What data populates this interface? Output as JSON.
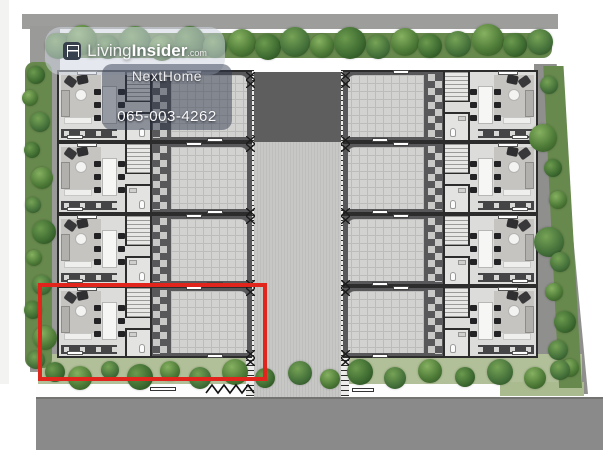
{
  "watermark": {
    "brand_part1": "Living",
    "brand_part2": "Insider",
    "brand_suffix": ".com"
  },
  "overlay": {
    "agent_name": "NextHome",
    "phone": "065-003-4262"
  },
  "site": {
    "left_unit_count": 4,
    "right_unit_count": 4,
    "highlight_color": "#e2251c"
  }
}
